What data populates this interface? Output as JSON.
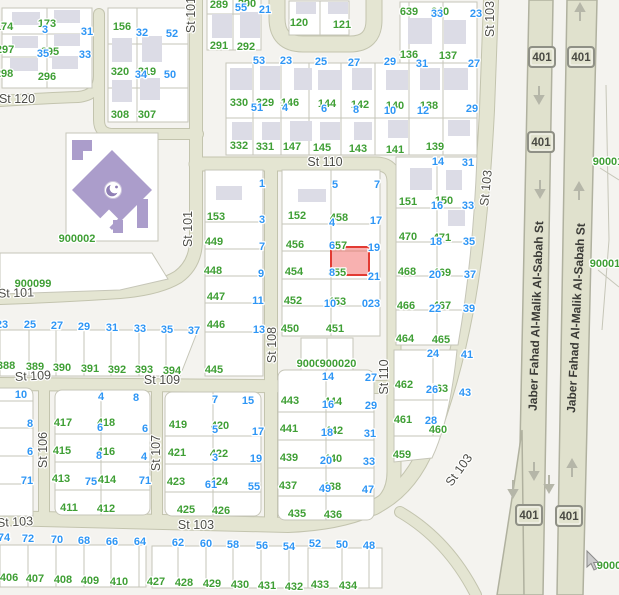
{
  "map": {
    "colors": {
      "background": "#f4f3ef",
      "street_fill": "#e4e5d2",
      "street_casing": "#c3c4ae",
      "highway_fill": "#e0e1cd",
      "block_fill": "#ffffff",
      "parcel_line": "#c6c6b8",
      "building": "#dcdce6",
      "mosque_purple": "#ab9dcb",
      "parcel_number_green": "#3f9f35",
      "address_number_blue": "#2e96f5",
      "street_label": "#4e4e48",
      "selected_fill": "rgba(239,83,80,0.45)",
      "selected_stroke": "#e23b33"
    },
    "selected_parcel": {
      "x": 331,
      "y": 247,
      "w": 38,
      "h": 28
    },
    "cursor": {
      "x": 587,
      "y": 551
    },
    "street_labels": [
      [
        "St 120",
        17,
        99,
        0
      ],
      [
        "St 101",
        191,
        15,
        -90
      ],
      [
        "St 101",
        188,
        229,
        -90
      ],
      [
        "St 101",
        16,
        293,
        -2
      ],
      [
        "St 110",
        325,
        162,
        0
      ],
      [
        "St 108",
        272,
        345,
        -90
      ],
      [
        "St 110",
        384,
        377,
        -90
      ],
      [
        "St 109",
        33,
        376,
        -3
      ],
      [
        "St 109",
        162,
        380,
        0
      ],
      [
        "St 106",
        43,
        450,
        -90
      ],
      [
        "St 107",
        156,
        453,
        -90
      ],
      [
        "St 103",
        490,
        19,
        -90
      ],
      [
        "St 103",
        486,
        188,
        -84
      ],
      [
        "St 103",
        459,
        470,
        -54
      ],
      [
        "St 103",
        15,
        522,
        -3
      ],
      [
        "St 103",
        196,
        525,
        0
      ],
      [
        "Jaber Fahad Al-Malik Al-Sabah St",
        536,
        316,
        -88
      ],
      [
        "Jaber Fahad Al-Malik Al-Sabah St",
        576,
        318,
        -87
      ]
    ],
    "highway": {
      "shield_text": "401",
      "shields": [
        [
          542,
          57
        ],
        [
          581,
          57
        ],
        [
          541,
          142
        ],
        [
          529,
          515
        ],
        [
          569,
          516
        ]
      ],
      "arrows_down": [
        [
          539,
          94
        ],
        [
          540,
          188
        ],
        [
          534,
          470
        ],
        [
          549,
          483
        ],
        [
          513,
          488
        ]
      ],
      "arrows_up": [
        [
          580,
          13
        ],
        [
          579,
          192
        ],
        [
          572,
          469
        ]
      ]
    },
    "green_labels": [
      [
        "174",
        4,
        26
      ],
      [
        "173",
        47,
        23
      ],
      [
        "297",
        5,
        49
      ],
      [
        "295",
        50,
        51
      ],
      [
        "298",
        4,
        73
      ],
      [
        "296",
        47,
        76
      ],
      [
        "156",
        122,
        26
      ],
      [
        "320",
        120,
        71
      ],
      [
        "319",
        147,
        71
      ],
      [
        "308",
        120,
        114
      ],
      [
        "307",
        147,
        114
      ],
      [
        "289",
        219,
        4
      ],
      [
        "290",
        247,
        3
      ],
      [
        "291",
        219,
        45
      ],
      [
        "292",
        246,
        46
      ],
      [
        "120",
        299,
        22
      ],
      [
        "121",
        342,
        24
      ],
      [
        "639",
        409,
        11
      ],
      [
        "640",
        440,
        11
      ],
      [
        "136",
        409,
        54
      ],
      [
        "137",
        448,
        55
      ],
      [
        "330",
        239,
        102
      ],
      [
        "329",
        265,
        102
      ],
      [
        "146",
        290,
        102
      ],
      [
        "144",
        327,
        103
      ],
      [
        "142",
        360,
        104
      ],
      [
        "140",
        395,
        105
      ],
      [
        "138",
        429,
        105
      ],
      [
        "332",
        239,
        145
      ],
      [
        "331",
        265,
        146
      ],
      [
        "147",
        292,
        146
      ],
      [
        "145",
        322,
        147
      ],
      [
        "143",
        358,
        148
      ],
      [
        "141",
        395,
        149
      ],
      [
        "139",
        435,
        146
      ],
      [
        "900002",
        77,
        238
      ],
      [
        "900099",
        33,
        283
      ],
      [
        "388",
        6,
        365
      ],
      [
        "389",
        35,
        366
      ],
      [
        "390",
        62,
        367
      ],
      [
        "391",
        90,
        368
      ],
      [
        "392",
        117,
        369
      ],
      [
        "393",
        144,
        369
      ],
      [
        "394",
        172,
        370
      ],
      [
        "153",
        216,
        216
      ],
      [
        "449",
        214,
        241
      ],
      [
        "448",
        213,
        270
      ],
      [
        "447",
        216,
        296
      ],
      [
        "446",
        216,
        324
      ],
      [
        "445",
        214,
        369
      ],
      [
        "152",
        297,
        215
      ],
      [
        "456",
        295,
        244
      ],
      [
        "454",
        294,
        271
      ],
      [
        "452",
        293,
        300
      ],
      [
        "450",
        290,
        328
      ],
      [
        "458",
        339,
        217
      ],
      [
        "457",
        338,
        245
      ],
      [
        "455",
        337,
        272
      ],
      [
        "453",
        337,
        301
      ],
      [
        "451",
        335,
        328
      ],
      [
        "900019",
        315,
        363
      ],
      [
        "900020",
        338,
        363
      ],
      [
        "151",
        408,
        201
      ],
      [
        "150",
        444,
        200
      ],
      [
        "470",
        408,
        236
      ],
      [
        "471",
        442,
        237
      ],
      [
        "468",
        407,
        271
      ],
      [
        "469",
        442,
        272
      ],
      [
        "466",
        406,
        305
      ],
      [
        "467",
        442,
        305
      ],
      [
        "464",
        405,
        338
      ],
      [
        "465",
        441,
        339
      ],
      [
        "462",
        404,
        384
      ],
      [
        "463",
        439,
        388
      ],
      [
        "461",
        403,
        419
      ],
      [
        "460",
        438,
        429
      ],
      [
        "459",
        402,
        454
      ],
      [
        "417",
        63,
        422
      ],
      [
        "418",
        106,
        422
      ],
      [
        "415",
        62,
        450
      ],
      [
        "416",
        106,
        451
      ],
      [
        "413",
        61,
        478
      ],
      [
        "414",
        107,
        479
      ],
      [
        "411",
        69,
        507
      ],
      [
        "412",
        106,
        508
      ],
      [
        "419",
        178,
        424
      ],
      [
        "420",
        220,
        425
      ],
      [
        "421",
        177,
        452
      ],
      [
        "422",
        219,
        453
      ],
      [
        "423",
        176,
        481
      ],
      [
        "424",
        219,
        481
      ],
      [
        "425",
        186,
        509
      ],
      [
        "426",
        221,
        510
      ],
      [
        "443",
        290,
        400
      ],
      [
        "444",
        333,
        401
      ],
      [
        "441",
        289,
        428
      ],
      [
        "442",
        334,
        430
      ],
      [
        "439",
        289,
        457
      ],
      [
        "440",
        333,
        458
      ],
      [
        "437",
        288,
        485
      ],
      [
        "438",
        332,
        486
      ],
      [
        "435",
        297,
        513
      ],
      [
        "436",
        333,
        514
      ],
      [
        "406",
        9,
        577
      ],
      [
        "407",
        35,
        578
      ],
      [
        "408",
        63,
        579
      ],
      [
        "409",
        90,
        580
      ],
      [
        "410",
        119,
        581
      ],
      [
        "427",
        156,
        581
      ],
      [
        "428",
        184,
        582
      ],
      [
        "429",
        212,
        583
      ],
      [
        "430",
        240,
        584
      ],
      [
        "431",
        267,
        585
      ],
      [
        "432",
        294,
        586
      ],
      [
        "433",
        320,
        584
      ],
      [
        "434",
        348,
        585
      ],
      [
        "90001",
        608,
        161
      ],
      [
        "90001",
        605,
        263
      ],
      [
        "9000",
        609,
        565
      ]
    ],
    "blue_labels": [
      [
        "3",
        45,
        29
      ],
      [
        "31",
        87,
        31
      ],
      [
        "35",
        43,
        53
      ],
      [
        "33",
        85,
        54
      ],
      [
        "32",
        142,
        32
      ],
      [
        "52",
        172,
        33
      ],
      [
        "34",
        141,
        74
      ],
      [
        "50",
        170,
        74
      ],
      [
        "55",
        241,
        7
      ],
      [
        "21",
        265,
        9
      ],
      [
        "53",
        259,
        60
      ],
      [
        "23",
        286,
        60
      ],
      [
        "25",
        321,
        61
      ],
      [
        "27",
        354,
        62
      ],
      [
        "29",
        390,
        61
      ],
      [
        "51",
        257,
        107
      ],
      [
        "4",
        285,
        107
      ],
      [
        "6",
        324,
        108
      ],
      [
        "8",
        356,
        109
      ],
      [
        "10",
        390,
        110
      ],
      [
        "12",
        423,
        110
      ],
      [
        "29",
        472,
        108
      ],
      [
        "33",
        437,
        13
      ],
      [
        "23",
        476,
        13
      ],
      [
        "31",
        422,
        63
      ],
      [
        "27",
        474,
        63
      ],
      [
        "1",
        262,
        183
      ],
      [
        "5",
        335,
        184
      ],
      [
        "7",
        377,
        184
      ],
      [
        "3",
        262,
        219
      ],
      [
        "4",
        332,
        222
      ],
      [
        "17",
        376,
        220
      ],
      [
        "7",
        262,
        246
      ],
      [
        "6",
        332,
        245
      ],
      [
        "19",
        374,
        247
      ],
      [
        "9",
        261,
        273
      ],
      [
        "8",
        332,
        272
      ],
      [
        "21",
        374,
        276
      ],
      [
        "11",
        258,
        300
      ],
      [
        "10",
        330,
        303
      ],
      [
        "023",
        371,
        303
      ],
      [
        "13",
        259,
        329
      ],
      [
        "14",
        328,
        376
      ],
      [
        "27",
        371,
        377
      ],
      [
        "14",
        438,
        161
      ],
      [
        "31",
        468,
        162
      ],
      [
        "16",
        437,
        205
      ],
      [
        "33",
        468,
        205
      ],
      [
        "18",
        436,
        241
      ],
      [
        "35",
        469,
        241
      ],
      [
        "20",
        435,
        274
      ],
      [
        "37",
        470,
        274
      ],
      [
        "22",
        435,
        308
      ],
      [
        "39",
        469,
        308
      ],
      [
        "24",
        433,
        353
      ],
      [
        "41",
        467,
        354
      ],
      [
        "26",
        432,
        389
      ],
      [
        "43",
        465,
        392
      ],
      [
        "28",
        431,
        420
      ],
      [
        "23",
        2,
        324
      ],
      [
        "25",
        30,
        324
      ],
      [
        "27",
        57,
        325
      ],
      [
        "29",
        84,
        326
      ],
      [
        "31",
        112,
        327
      ],
      [
        "33",
        140,
        328
      ],
      [
        "35",
        167,
        329
      ],
      [
        "37",
        194,
        330
      ],
      [
        "10",
        21,
        394
      ],
      [
        "8",
        30,
        423
      ],
      [
        "6",
        30,
        451
      ],
      [
        "71",
        27,
        480
      ],
      [
        "4",
        101,
        396
      ],
      [
        "8",
        136,
        397
      ],
      [
        "6",
        100,
        427
      ],
      [
        "6",
        145,
        428
      ],
      [
        "8",
        99,
        455
      ],
      [
        "4",
        144,
        456
      ],
      [
        "75",
        91,
        481
      ],
      [
        "71",
        145,
        480
      ],
      [
        "7",
        215,
        399
      ],
      [
        "15",
        248,
        400
      ],
      [
        "5",
        215,
        429
      ],
      [
        "17",
        258,
        431
      ],
      [
        "3",
        215,
        457
      ],
      [
        "19",
        256,
        458
      ],
      [
        "61",
        211,
        484
      ],
      [
        "55",
        254,
        486
      ],
      [
        "16",
        328,
        404
      ],
      [
        "29",
        371,
        405
      ],
      [
        "18",
        327,
        432
      ],
      [
        "31",
        370,
        433
      ],
      [
        "20",
        326,
        460
      ],
      [
        "33",
        369,
        461
      ],
      [
        "49",
        325,
        488
      ],
      [
        "47",
        368,
        489
      ],
      [
        "74",
        4,
        537
      ],
      [
        "72",
        28,
        538
      ],
      [
        "70",
        57,
        539
      ],
      [
        "68",
        84,
        540
      ],
      [
        "66",
        112,
        541
      ],
      [
        "64",
        140,
        541
      ],
      [
        "62",
        178,
        542
      ],
      [
        "60",
        206,
        543
      ],
      [
        "58",
        233,
        544
      ],
      [
        "56",
        262,
        545
      ],
      [
        "54",
        289,
        546
      ],
      [
        "52",
        315,
        543
      ],
      [
        "50",
        342,
        544
      ],
      [
        "48",
        369,
        545
      ]
    ]
  }
}
